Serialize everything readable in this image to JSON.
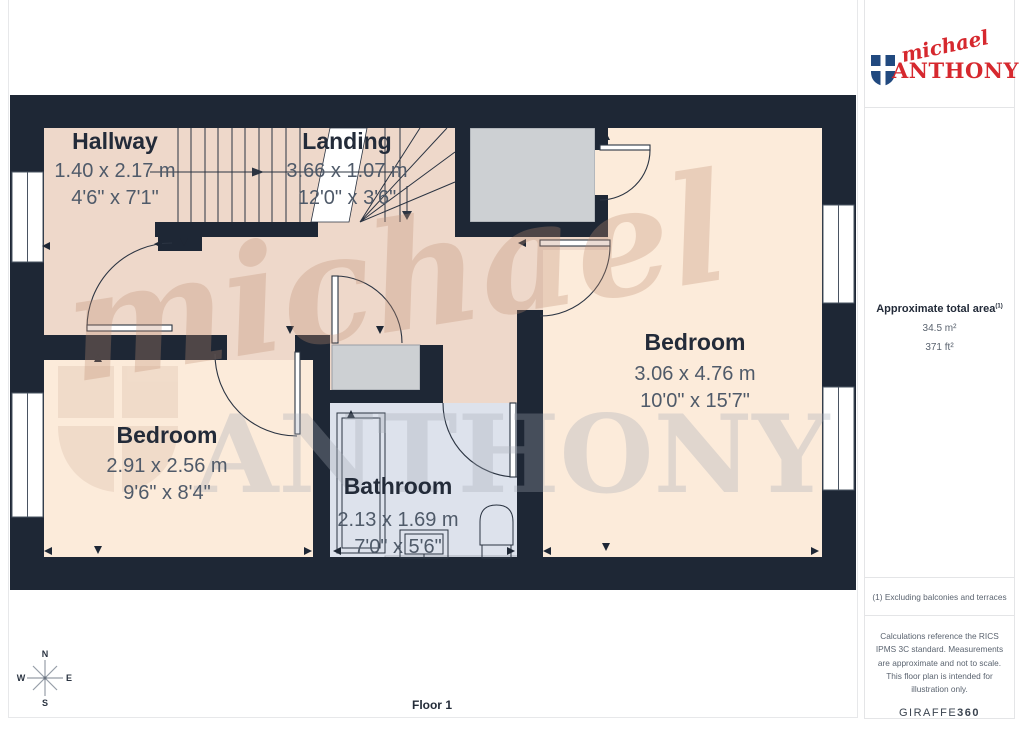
{
  "plan": {
    "floor_label": "Floor 1",
    "rooms": [
      {
        "id": "hallway",
        "name": "Hallway",
        "metric": "1.40 x 2.17 m",
        "imperial": "4'6\" x 7'1\""
      },
      {
        "id": "landing",
        "name": "Landing",
        "metric": "3.66 x 1.07 m",
        "imperial": "12'0\" x 3'6\""
      },
      {
        "id": "bedroom-right",
        "name": "Bedroom",
        "metric": "3.06 x 4.76 m",
        "imperial": "10'0\" x 15'7\""
      },
      {
        "id": "bedroom-left",
        "name": "Bedroom",
        "metric": "2.91 x 2.56 m",
        "imperial": "9'6\" x 8'4\""
      },
      {
        "id": "bathroom",
        "name": "Bathroom",
        "metric": "2.13 x 1.69 m",
        "imperial": "7'0\" x 5'6\""
      }
    ],
    "compass": {
      "n": "N",
      "e": "E",
      "s": "S",
      "w": "W"
    }
  },
  "watermark": {
    "script": "michael",
    "serif": "ANTHONY"
  },
  "branding": {
    "logo_script": "michael",
    "logo_name": "ANTHONY",
    "red": "#d6282e",
    "blue": "#21497f"
  },
  "sidebar": {
    "area_title": "Approximate total area",
    "area_sup": "(1)",
    "area_m2": "34.5 m²",
    "area_ft2": "371 ft²",
    "note": "(1) Excluding balconies and terraces",
    "disclaimer": "Calculations reference the RICS IPMS 3C standard. Measurements are approximate and not to scale. This floor plan is intended for illustration only.",
    "credit_name": "GIRAFFE",
    "credit_suffix": "360"
  },
  "palette": {
    "wall": "#1e2735",
    "hallway_floor": "#eed8ca",
    "bedroom_floor": "#fcebda",
    "bathroom_floor": "#dde2ec",
    "closet": "#cdd0d3"
  }
}
